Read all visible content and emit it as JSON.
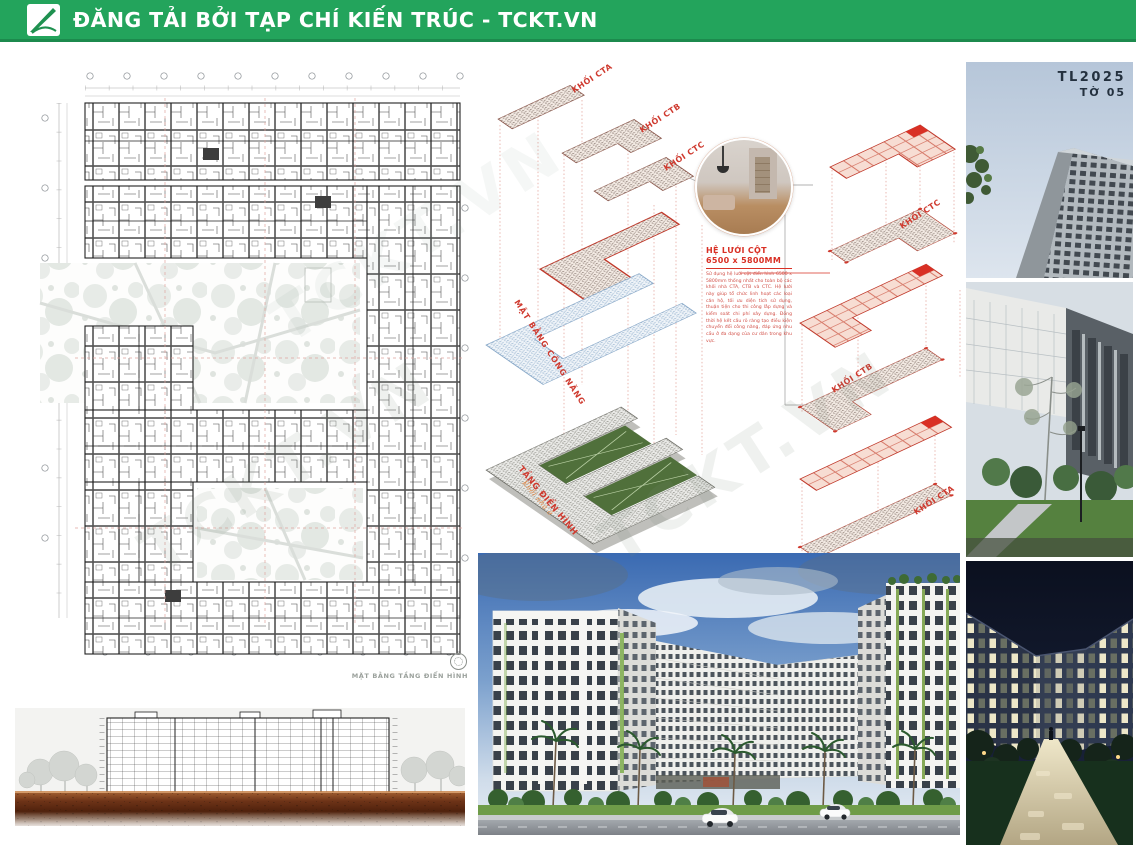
{
  "header": {
    "title": "ĐĂNG TẢI BỞI TẠP CHÍ KIẾN TRÚC - TCKT.VN"
  },
  "sheet": {
    "code": "TL2025",
    "number": "TỜ 05"
  },
  "watermark": {
    "text": "TCKT.VN"
  },
  "left_plan": {
    "caption": "MẶT BẰNG TẦNG ĐIỂN HÌNH"
  },
  "axon_left": {
    "blocks": [
      {
        "label": "KHỐI CTA"
      },
      {
        "label": "KHỐI CTB"
      },
      {
        "label": "KHỐI CTC"
      }
    ],
    "functional_plan_label": "MẶT BẰNG CÔNG NĂNG",
    "typical_floor_label": "TẦNG ĐIỂN HÌNH",
    "typical_floor_sub": "Khối nhà ở"
  },
  "axon_right": {
    "blocks": [
      {
        "label": "KHỐI CTC"
      },
      {
        "label": "KHỐI CTB"
      },
      {
        "label": "KHỐI CTA"
      }
    ]
  },
  "note": {
    "title_line1": "HỆ LƯỚI CỘT",
    "title_line2": "6500 x 5800MM",
    "body": "Sử dụng hệ lưới cột điển hình 6500 x 5800mm thống nhất cho toàn bộ các khối nhà CTA, CTB và CTC. Hệ lưới này giúp tổ chức linh hoạt các loại căn hộ, tối ưu diện tích sử dụng, thuận tiện cho thi công lắp dựng và kiểm soát chi phí xây dựng. Đồng thời hệ kết cấu rõ ràng tạo điều kiện chuyển đổi công năng, đáp ứng nhu cầu ở đa dạng của cư dân trong khu vực."
  },
  "colors": {
    "header_green": "#23a45c",
    "accent_red": "#d93025",
    "grid_pink": "#f7ddd3"
  }
}
